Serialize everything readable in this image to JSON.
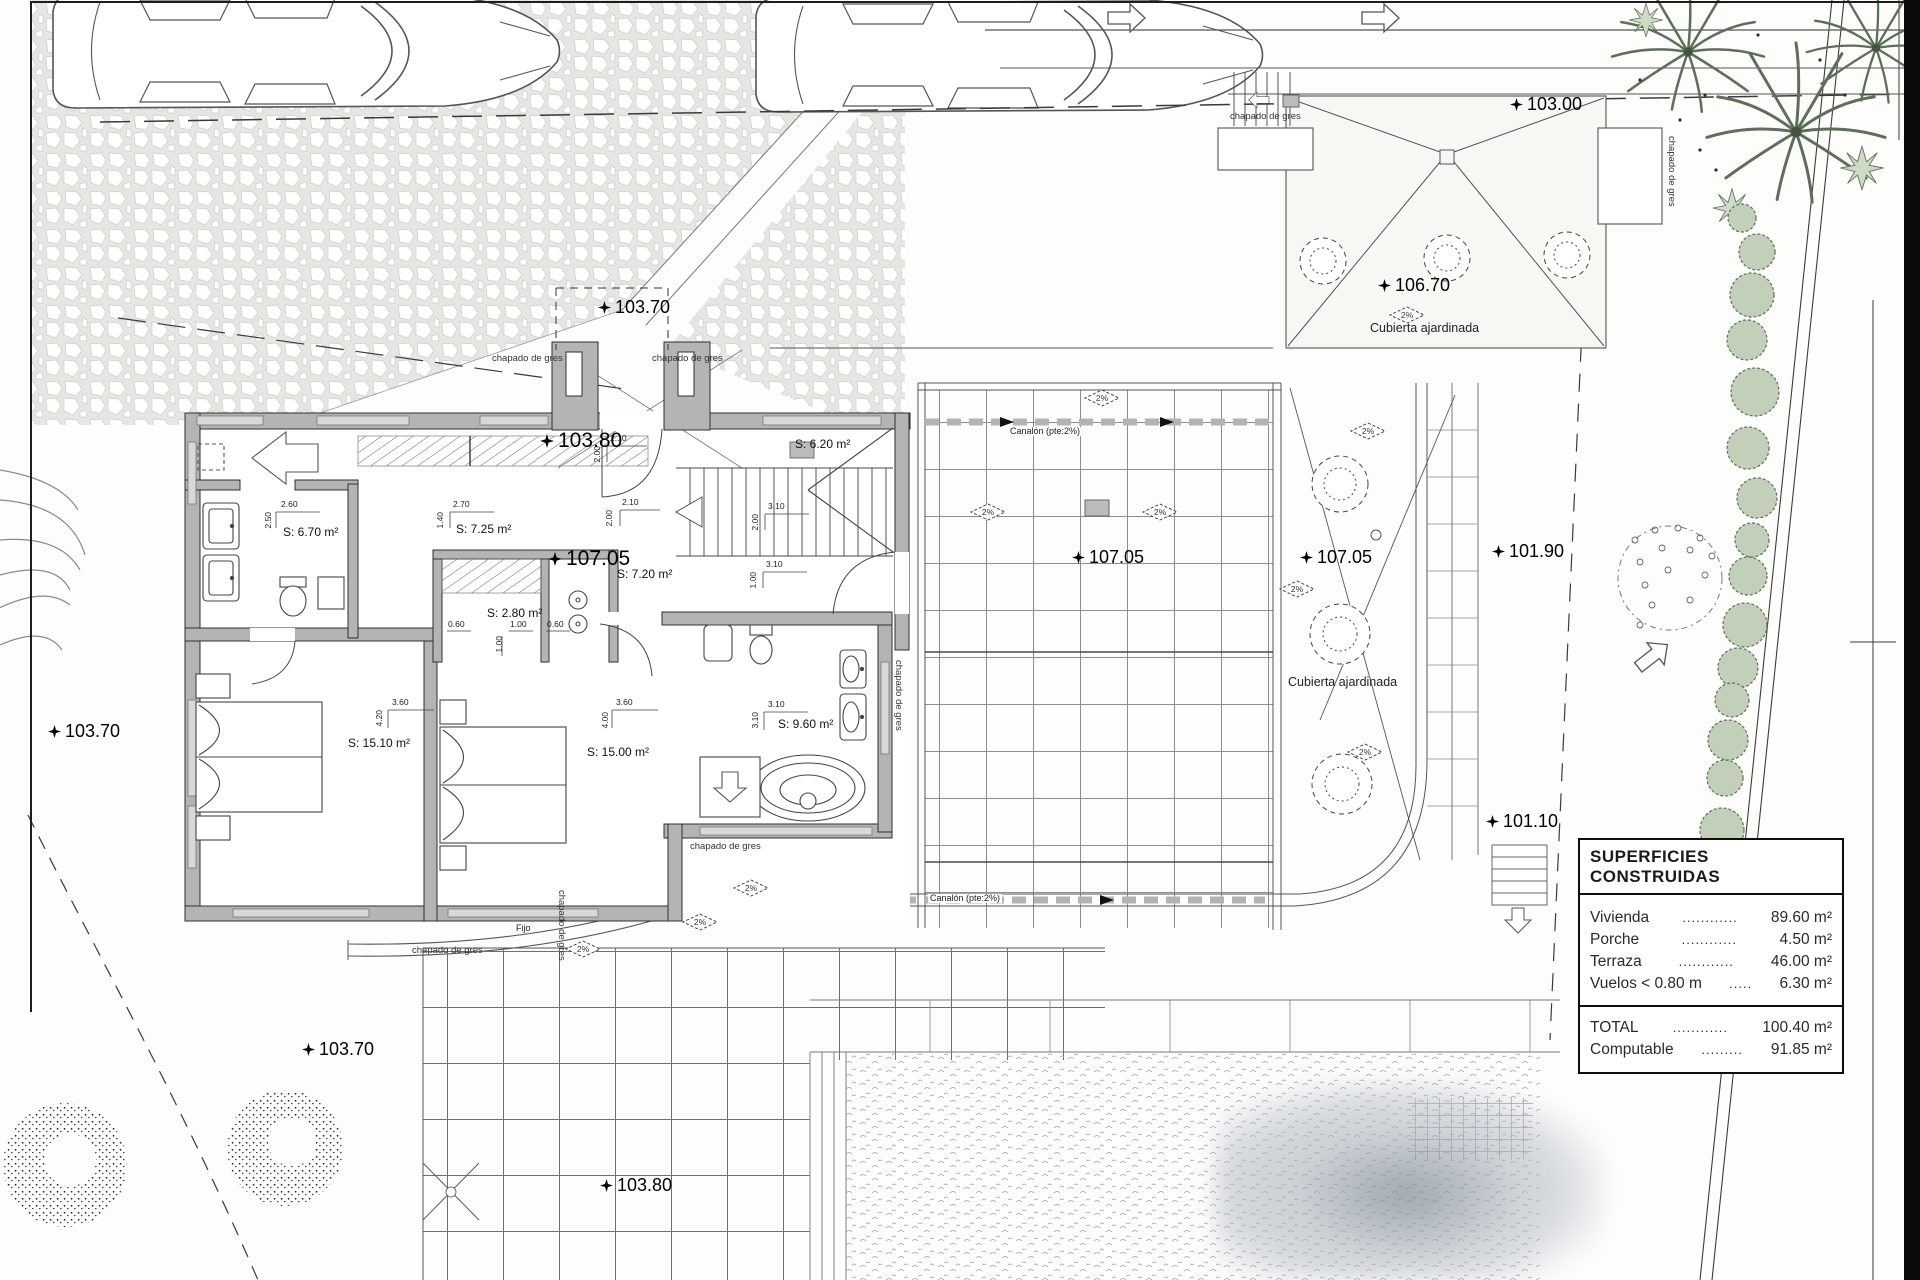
{
  "drawing": {
    "labels": {
      "slope": "2%",
      "chapado": "chapado de gres",
      "canalon": "Canalón (pte:2%)",
      "cubierta": "Cubierta ajardinada",
      "fijo": "Fijo"
    },
    "levels": [
      {
        "id": "103-00",
        "value": "103.00"
      },
      {
        "id": "103-70-top",
        "value": "103.70"
      },
      {
        "id": "103-70-left",
        "value": "103.70"
      },
      {
        "id": "103-70-bottom",
        "value": "103.70"
      },
      {
        "id": "103-80-porch",
        "value": "103.80"
      },
      {
        "id": "103-80-bottom",
        "value": "103.80"
      },
      {
        "id": "106-70",
        "value": "106.70"
      },
      {
        "id": "107-05-hall",
        "value": "107.05"
      },
      {
        "id": "107-05-terrace",
        "value": "107.05"
      },
      {
        "id": "107-05-garden",
        "value": "107.05"
      },
      {
        "id": "101-90",
        "value": "101.90"
      },
      {
        "id": "101-10",
        "value": "101.10"
      }
    ],
    "rooms": [
      {
        "id": "bath-left",
        "area": "S: 6.70 m²"
      },
      {
        "id": "distributor",
        "area": "S: 7.25 m²"
      },
      {
        "id": "closet",
        "area": "S: 2.80 m²"
      },
      {
        "id": "bedroom-1",
        "area": "S: 15.10 m²"
      },
      {
        "id": "bedroom-2",
        "area": "S: 15.00 m²"
      },
      {
        "id": "landing",
        "area": "S: 7.20 m²"
      },
      {
        "id": "bath-main",
        "area": "S: 9.60 m²"
      },
      {
        "id": "stairwell",
        "area": "S: 6.20 m²"
      }
    ],
    "dimensions": [
      "2.60",
      "2.50",
      "2.70",
      "1.40",
      "2.10",
      "2.00",
      "3.10",
      "2.00",
      "3.10",
      "1.00",
      "0.60",
      "1.00",
      "0.60",
      "1.00",
      "3.60",
      "4.20",
      "3.60",
      "4.00",
      "3.10",
      "3.10",
      "2.10",
      "2.00"
    ]
  },
  "legend": {
    "title": "SUPERFICIES CONSTRUIDAS",
    "rows": [
      {
        "label": "Vivienda",
        "dots": "............",
        "value": "89.60 m²"
      },
      {
        "label": "Porche",
        "dots": "............",
        "value": "4.50 m²"
      },
      {
        "label": "Terraza",
        "dots": "............",
        "value": "46.00 m²"
      },
      {
        "label": "Vuelos < 0.80 m",
        "dots": ".....",
        "value": "6.30 m²"
      }
    ],
    "totals": [
      {
        "label": "TOTAL",
        "dots": "............",
        "value": "100.40 m²"
      },
      {
        "label": "Computable",
        "dots": ".........",
        "value": "91.85 m²"
      }
    ]
  },
  "palette": {
    "line": "#3a3a3a",
    "wall_fill": "#b4b4b4",
    "vegetation_stroke": "#5c6f57",
    "vegetation_fill": "#c2d0ba",
    "paper": "#ffffff"
  }
}
